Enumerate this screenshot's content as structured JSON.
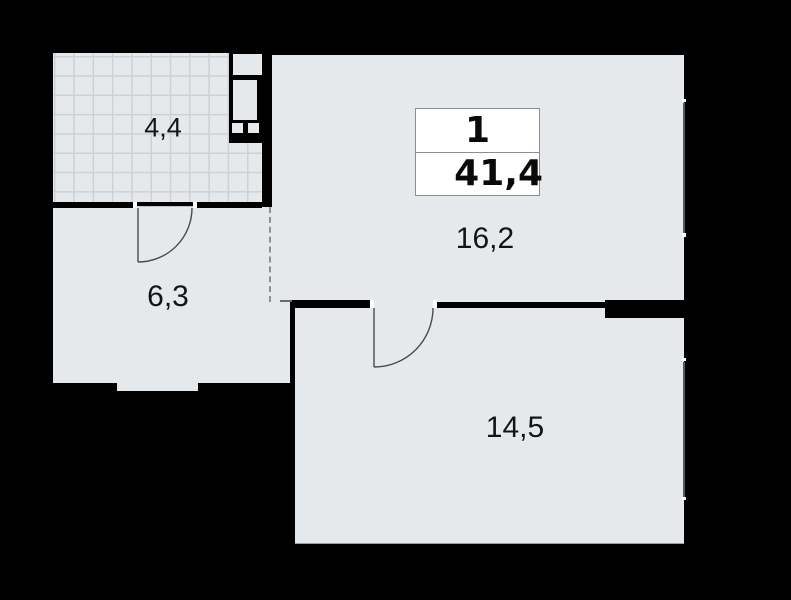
{
  "plan": {
    "legend": {
      "rooms_count": "1",
      "total_area": "41,4"
    },
    "rooms": [
      {
        "name": "loggia",
        "area": "4,4"
      },
      {
        "name": "hallway",
        "area": "6,3"
      },
      {
        "name": "living-room",
        "area": "16,2"
      },
      {
        "name": "bedroom",
        "area": "14,5"
      }
    ],
    "colors": {
      "background": "#000000",
      "floor": "#e6e9ec",
      "grid_line": "#cdd1d5",
      "wall": "#000000",
      "window_line": "#555a5f",
      "door_line": "#4a4a4a",
      "dashed_line": "#8a9096",
      "legend_background": "#ffffff",
      "legend_border": "#8a8f94",
      "text": "#141414"
    }
  }
}
